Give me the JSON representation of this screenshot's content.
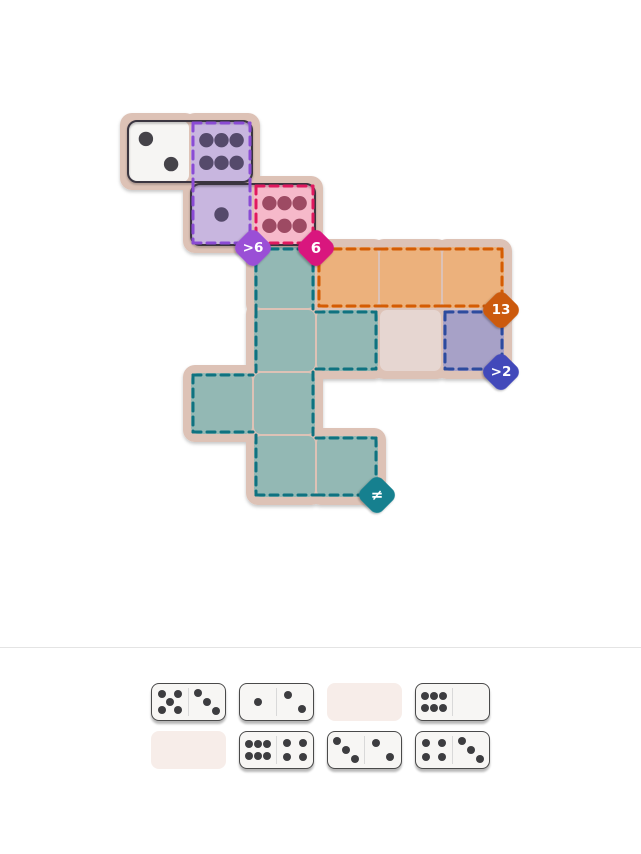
{
  "colors": {
    "page_bg": "#ffffff",
    "board_backdrop": "#ddc2b6",
    "plain_cell": "#e6d6d1",
    "placed_white": "#f6f5f3",
    "default_pip": "#454349",
    "domino_outline": "#3a3440",
    "divider": "#e4e4e4",
    "tile_fill": "#f7f6f4",
    "tile_border": "#4a4a4a",
    "tile_divider": "#d9d9d9",
    "tile_pip": "#3d3d40",
    "empty_slot": "#f7ede9",
    "badge_text": "#ffffff"
  },
  "board": {
    "origin_x": 127,
    "origin_y": 120,
    "cell_size": 63,
    "regions": {
      "purple": {
        "fill": "#c8b6df",
        "stroke": "#8a4bd4",
        "pip": "#554a6b"
      },
      "pink": {
        "fill": "#f6b9ca",
        "stroke": "#e0195f",
        "pip": "#9d4a63"
      },
      "teal": {
        "fill": "#93b8b4",
        "stroke": "#0f7280"
      },
      "orange": {
        "fill": "#ecb17c",
        "stroke": "#d45c04"
      },
      "blue": {
        "fill": "#a7a1c7",
        "stroke": "#2d4b9e"
      }
    },
    "cells": [
      {
        "col": 0,
        "row": 0,
        "region": null,
        "pips": 2
      },
      {
        "col": 1,
        "row": 0,
        "region": "purple",
        "pips": 6
      },
      {
        "col": 1,
        "row": 1,
        "region": "purple",
        "pips": 1
      },
      {
        "col": 2,
        "row": 1,
        "region": "pink",
        "pips": 6
      },
      {
        "col": 2,
        "row": 2,
        "region": "teal",
        "pips": null
      },
      {
        "col": 3,
        "row": 2,
        "region": "orange",
        "pips": null
      },
      {
        "col": 4,
        "row": 2,
        "region": "orange",
        "pips": null
      },
      {
        "col": 5,
        "row": 2,
        "region": "orange",
        "pips": null
      },
      {
        "col": 2,
        "row": 3,
        "region": "teal",
        "pips": null
      },
      {
        "col": 3,
        "row": 3,
        "region": "teal",
        "pips": null
      },
      {
        "col": 4,
        "row": 3,
        "region": null,
        "pips": null
      },
      {
        "col": 5,
        "row": 3,
        "region": "blue",
        "pips": null
      },
      {
        "col": 1,
        "row": 4,
        "region": "teal",
        "pips": null
      },
      {
        "col": 2,
        "row": 4,
        "region": "teal",
        "pips": null
      },
      {
        "col": 2,
        "row": 5,
        "region": "teal",
        "pips": null
      },
      {
        "col": 3,
        "row": 5,
        "region": "teal",
        "pips": null
      }
    ],
    "placed_dominoes": [
      {
        "cells": [
          [
            0,
            0
          ],
          [
            1,
            0
          ]
        ],
        "values": [
          2,
          6
        ]
      },
      {
        "cells": [
          [
            1,
            1
          ],
          [
            2,
            1
          ]
        ],
        "values": [
          1,
          6
        ]
      }
    ],
    "badges": [
      {
        "label": ">6",
        "name": "gt6",
        "color": "#9a4fd6",
        "x": 253,
        "y": 248
      },
      {
        "label": "6",
        "name": "6",
        "color": "#d9157e",
        "x": 316,
        "y": 248
      },
      {
        "label": "13",
        "name": "13",
        "color": "#cc5a0d",
        "x": 501,
        "y": 310
      },
      {
        "label": ">2",
        "name": "gt2",
        "color": "#4248ba",
        "x": 501,
        "y": 372
      },
      {
        "label": "≠",
        "name": "neq",
        "color": "#15808f",
        "x": 377,
        "y": 495
      }
    ]
  },
  "tray": {
    "slots": [
      [
        {
          "left": 5,
          "right": 3
        },
        {
          "left": 1,
          "right": 2
        },
        {
          "empty": true
        },
        {
          "left": 6,
          "right": 0
        }
      ],
      [
        {
          "empty": true
        },
        {
          "left": 6,
          "right": 4
        },
        {
          "left": 3,
          "right": 2
        },
        {
          "left": 4,
          "right": 3
        }
      ]
    ]
  }
}
